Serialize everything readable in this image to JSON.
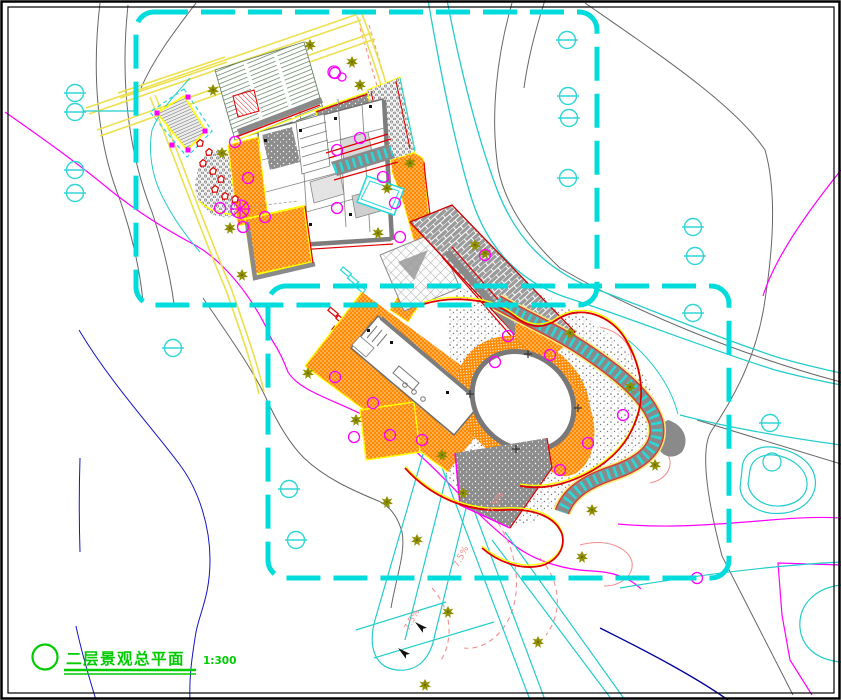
{
  "canvas": {
    "width": 841,
    "height": 700,
    "bg": "#ffffff"
  },
  "title_block": {
    "label": "二层景观总平面",
    "scale": "1:300"
  },
  "slope_labels": [
    {
      "text": "7.5%",
      "x": 493,
      "y": 514,
      "rot": -62
    },
    {
      "text": "7.5%",
      "x": 458,
      "y": 568,
      "rot": -62
    },
    {
      "text": "7.5%",
      "x": 409,
      "y": 631,
      "rot": -62
    }
  ],
  "palette": {
    "boundary_cyan": "#00dcdc",
    "road_cyan": "#25cccc",
    "symbol_cyan": "#30d5d5",
    "road_yellow": "#ece04e",
    "border_yellow": "#ffff00",
    "paving_orange": "#ff8a00",
    "edge_red": "#e00000",
    "contour_magenta": "#ff00ff",
    "contour_salmon": "#f49090",
    "tree_olive": "#8f8f00",
    "wall_gray": "#7d7d7d",
    "contour_gray": "#666666",
    "contour_blue": "#1414c8",
    "contour_navy": "#000099",
    "title_green": "#00cc00",
    "stripe_green": "#5d7a5d"
  },
  "symbols": {
    "survey_markers": [
      [
        75,
        93
      ],
      [
        75,
        112
      ],
      [
        75,
        170
      ],
      [
        75,
        193
      ],
      [
        173,
        348
      ],
      [
        289,
        489
      ],
      [
        296,
        540
      ],
      [
        567,
        40
      ],
      [
        568,
        96
      ],
      [
        569,
        118
      ],
      [
        568,
        178
      ],
      [
        693,
        227
      ],
      [
        695,
        256
      ],
      [
        693,
        313
      ],
      [
        770,
        423
      ]
    ],
    "trees": [
      [
        213,
        90
      ],
      [
        222,
        153
      ],
      [
        310,
        45
      ],
      [
        352,
        62
      ],
      [
        360,
        85
      ],
      [
        410,
        163
      ],
      [
        387,
        188
      ],
      [
        378,
        233
      ],
      [
        475,
        245
      ],
      [
        485,
        253
      ],
      [
        230,
        228
      ],
      [
        242,
        275
      ],
      [
        308,
        373
      ],
      [
        356,
        420
      ],
      [
        442,
        455
      ],
      [
        463,
        493
      ],
      [
        387,
        502
      ],
      [
        417,
        540
      ],
      [
        570,
        333
      ],
      [
        630,
        387
      ],
      [
        592,
        510
      ],
      [
        655,
        465
      ],
      [
        582,
        557
      ],
      [
        425,
        685
      ],
      [
        538,
        642
      ],
      [
        448,
        612
      ]
    ],
    "shrub_circles": [
      [
        235,
        142
      ],
      [
        337,
        150
      ],
      [
        265,
        217
      ],
      [
        383,
        177
      ],
      [
        335,
        377
      ],
      [
        373,
        403
      ],
      [
        422,
        440
      ],
      [
        354,
        437
      ],
      [
        550,
        355
      ],
      [
        508,
        336
      ],
      [
        495,
        362
      ],
      [
        588,
        443
      ],
      [
        560,
        470
      ],
      [
        697,
        578
      ],
      [
        335,
        73
      ],
      [
        360,
        138
      ],
      [
        395,
        203
      ],
      [
        400,
        237
      ],
      [
        485,
        255
      ],
      [
        220,
        208
      ],
      [
        243,
        227
      ],
      [
        337,
        208
      ],
      [
        623,
        415
      ],
      [
        390,
        435
      ],
      [
        248,
        178
      ]
    ],
    "corner_dots": [
      [
        188,
        97
      ],
      [
        157,
        113
      ],
      [
        205,
        131
      ],
      [
        172,
        145
      ],
      [
        188,
        150
      ]
    ],
    "rocks": [
      [
        200,
        143
      ],
      [
        209,
        152
      ],
      [
        203,
        163
      ],
      [
        213,
        171
      ],
      [
        221,
        179
      ],
      [
        215,
        189
      ],
      [
        225,
        196
      ],
      [
        235,
        199
      ]
    ],
    "plus_marks": [
      [
        470,
        394
      ],
      [
        528,
        354
      ],
      [
        578,
        408
      ],
      [
        516,
        449
      ]
    ],
    "arrows": [
      {
        "x": 415,
        "y": 622,
        "rot": 40
      },
      {
        "x": 398,
        "y": 648,
        "rot": 40
      }
    ]
  }
}
